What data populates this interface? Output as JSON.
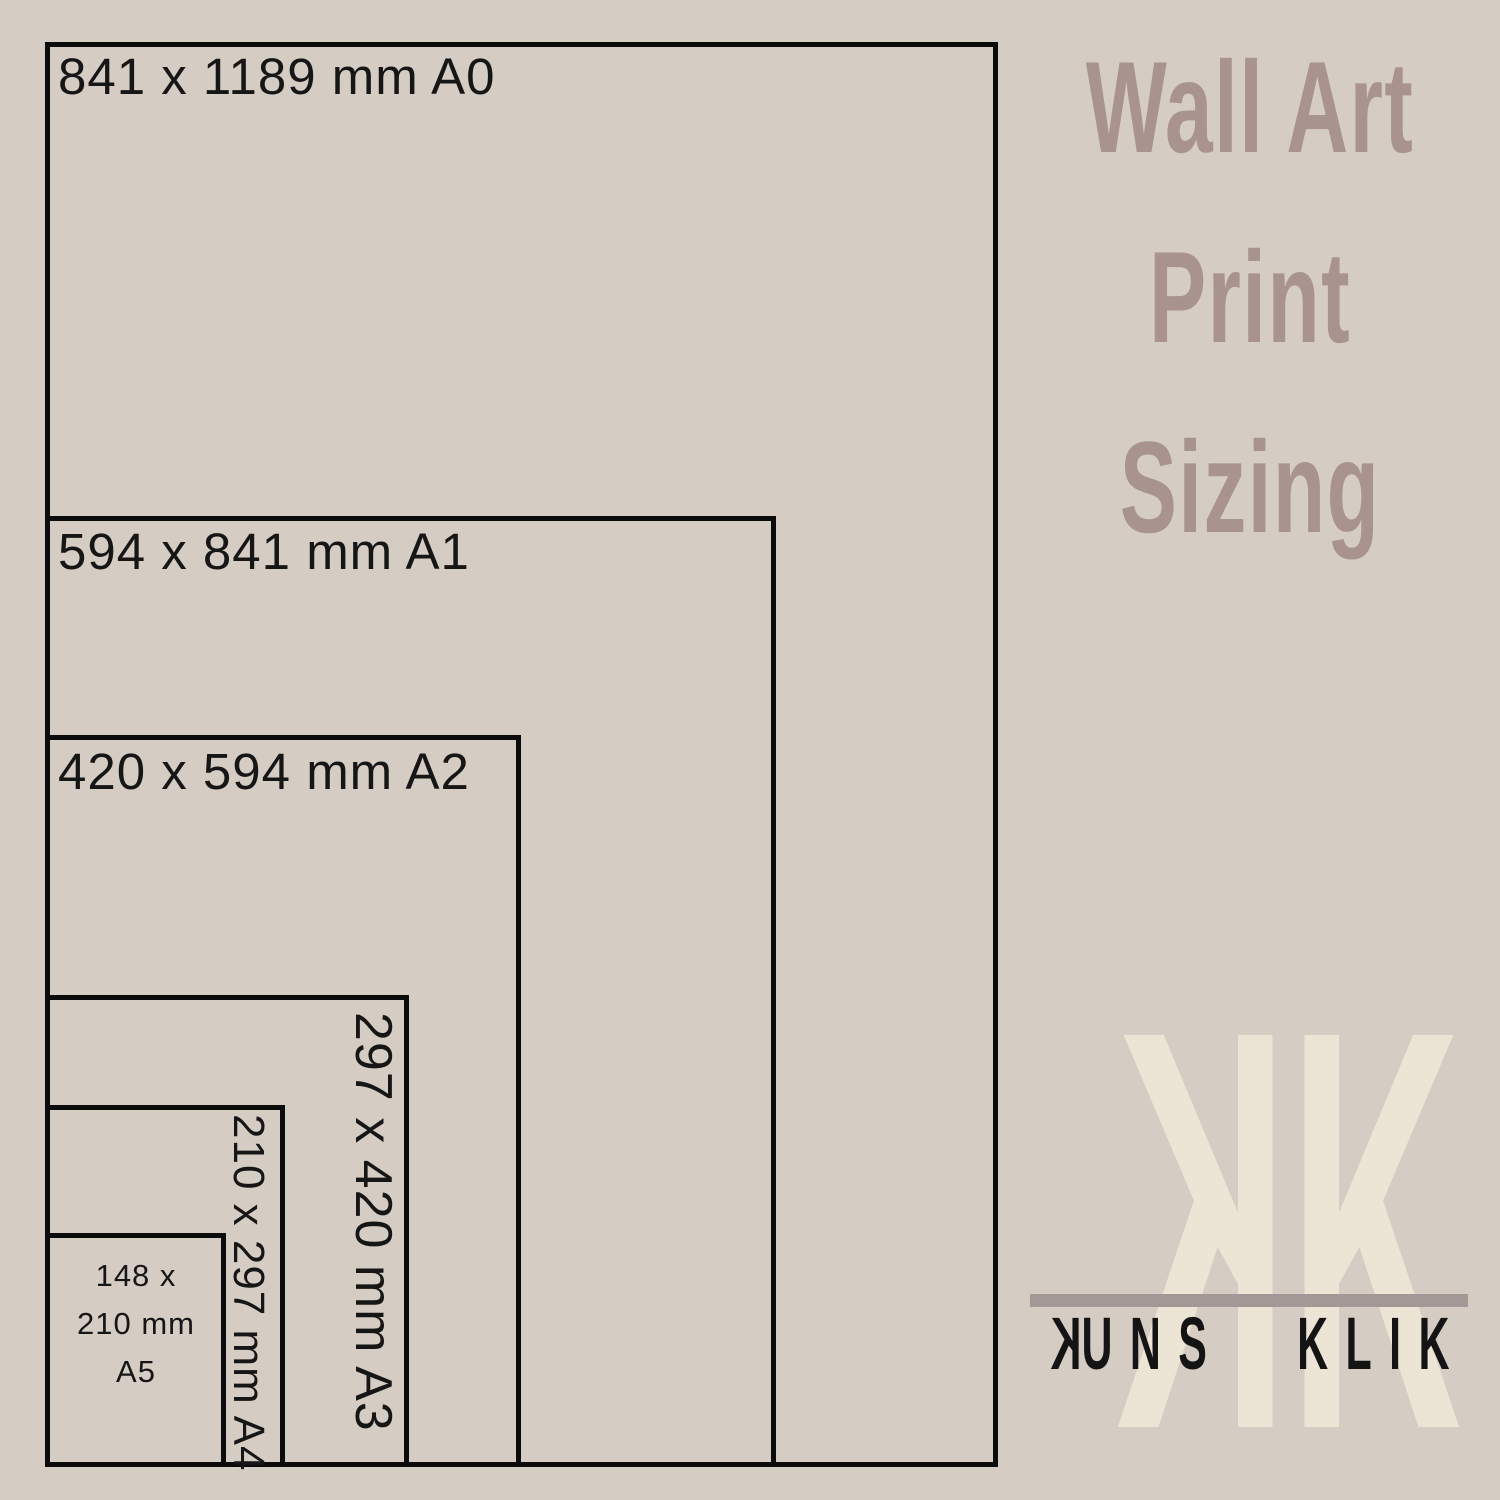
{
  "page": {
    "background_color": "#d5ccc3",
    "line_color": "#0b0b0b"
  },
  "diagram": {
    "description": "Nested paper size comparison rectangles",
    "sizes": [
      {
        "code": "A0",
        "width_mm": 841,
        "height_mm": 1189,
        "label": "841 x 1189 mm A0",
        "label_orientation": "horizontal"
      },
      {
        "code": "A1",
        "width_mm": 594,
        "height_mm": 841,
        "label": "594 x 841 mm A1",
        "label_orientation": "horizontal"
      },
      {
        "code": "A2",
        "width_mm": 420,
        "height_mm": 594,
        "label": "420 x 594 mm A2",
        "label_orientation": "horizontal"
      },
      {
        "code": "A3",
        "width_mm": 297,
        "height_mm": 420,
        "label": "297 x 420 mm A3",
        "label_orientation": "vertical"
      },
      {
        "code": "A4",
        "width_mm": 210,
        "height_mm": 297,
        "label": "210 x 297 mm A4",
        "label_orientation": "vertical"
      },
      {
        "code": "A5",
        "width_mm": 148,
        "height_mm": 210,
        "label": "148 x\n210 mm\nA5",
        "label_orientation": "stacked"
      }
    ]
  },
  "branding": {
    "title": {
      "line1": "Wall Art",
      "line2": "Print",
      "line3": "Sizing",
      "color": "#a8938e"
    },
    "monogram": {
      "letter_left": "K",
      "letter_left_mirrored": true,
      "letter_right": "K",
      "color": "#ece4d4"
    },
    "divider_color": "#a39895",
    "brand_name": {
      "display": "KUNS KLIK",
      "first_letter": "K",
      "first_letter_mirrored": true,
      "rest": "UNS KLIK",
      "color": "#141414"
    }
  }
}
